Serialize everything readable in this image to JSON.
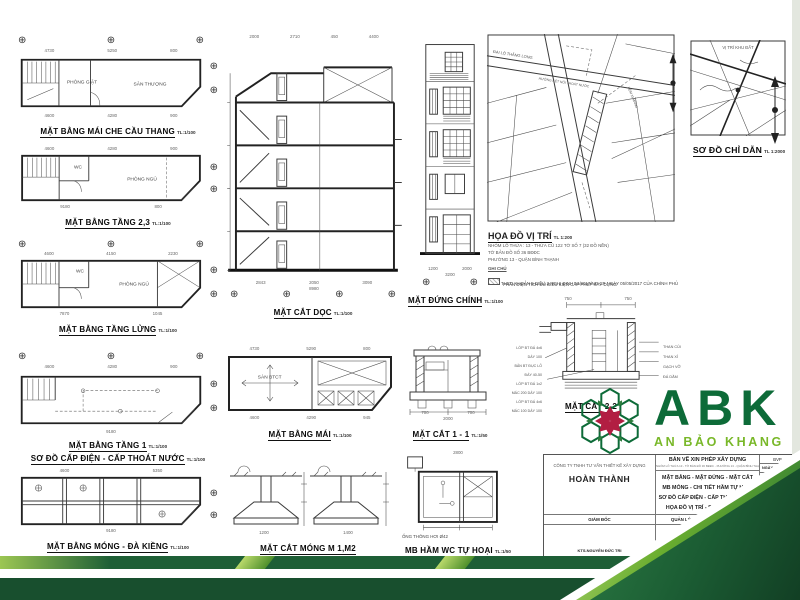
{
  "icons": {
    "axis_marker": "⊕"
  },
  "drawings": {
    "p1": {
      "title": "MẶT BẰNG MÁI CHE CẦU THANG",
      "scale": "TL:1/100",
      "room_a": "PHÒNG GIẶT",
      "room_b": "SÂN THƯỢNG",
      "dims_top": [
        "4730",
        "5250",
        "800"
      ],
      "dims_bottom": [
        "4600",
        "4280",
        "900"
      ]
    },
    "p2": {
      "title": "MẶT BẰNG TẦNG 2,3",
      "scale": "TL:1/100",
      "room_a": "WC",
      "room_b": "PHÒNG NGỦ",
      "dims_top": [
        "4600",
        "4280",
        "900"
      ],
      "dims_bottom": [
        "9180",
        "800"
      ]
    },
    "p3": {
      "title": "MẶT BẰNG TẦNG LỬNG",
      "scale": "TL:1/100",
      "room_a": "WC",
      "room_b": "PHÒNG NGỦ",
      "dims_top": [
        "4600",
        "4150",
        "2230"
      ],
      "dims_bottom": [
        "7870",
        "1045"
      ]
    },
    "p4": {
      "title": "MẶT BẰNG TẦNG 1",
      "scale": "TL:1/100",
      "subtitle": "SƠ ĐỒ CẤP ĐIỆN - CẤP THOÁT NƯỚC",
      "subtitle_scale": "TL:1/100",
      "dims_top": [
        "4600",
        "4280",
        "900"
      ],
      "dims_bottom": [
        "9180"
      ]
    },
    "p5": {
      "title": "MẶT BẰNG MÓNG - ĐÀ KIỀNG",
      "scale": "TL:1/100",
      "dims_top": [
        "4600",
        "5350"
      ],
      "dims_bottom": [
        "9180"
      ]
    },
    "sec": {
      "title": "MẶT CẮT DỌC",
      "scale": "TL:1/100",
      "dims_top": [
        "2000",
        "2710",
        "450",
        "4400"
      ],
      "dims_bottom": [
        "2843",
        "2050",
        "3090"
      ],
      "dim_overall": "8980"
    },
    "elev": {
      "title": "MẶT ĐỨNG CHÍNH",
      "scale": "TL:1/100",
      "dims_bottom": [
        "1200",
        "2000"
      ],
      "dim_overall": "3200"
    },
    "roof": {
      "title": "MẶT BẰNG MÁI",
      "scale": "TL:1/100",
      "room_a": "SÀN BTCT",
      "dims_top": [
        "4730",
        "5290",
        "800"
      ],
      "dims_bottom": [
        "4600",
        "4290",
        "945"
      ]
    },
    "s11": {
      "title": "MẶT CẮT 1 - 1",
      "scale": "TL:1/50",
      "dims_bottom": [
        "700",
        "700"
      ],
      "dim_overall": "2000"
    },
    "m12": {
      "title": "MẶT CẮT MÓNG M 1,M2",
      "dims": [
        "1200",
        "1400"
      ]
    },
    "septic": {
      "title": "MB HẦM WC TỰ HOẠI",
      "scale": "TL:1/50",
      "note": "ỐNG THÔNG HƠI Ø42",
      "dim_top": "2800"
    },
    "s22": {
      "title": "MẶT CẮT 2-2",
      "labels_left": [
        "LỚP BT ĐÁ 4x6 DÀY 100",
        "BẢN BT ĐỤC LỖ ĐÁY 40-50",
        "LỚP BT ĐÁ 1x2 MÁC 200 DÀY 100",
        "LỚP BT ĐÁ 4x6 MÁC 100 DÀY 100"
      ],
      "labels_right": [
        "THAN CỦI",
        "THAN XỈ",
        "GẠCH VỠ",
        "ĐÁ DĂM"
      ],
      "dims_top": [
        "750",
        "750"
      ]
    },
    "locmap": {
      "title": "HỌA ĐỒ VỊ TRÍ",
      "scale": "TL 1:200",
      "notes": [
        "NHÓM LÔ THỬA : 13 - THỬA CŨ 122 TỜ SỐ 7 (32 ĐỒ NỀN)",
        "TỜ BẢN ĐỒ SỐ 36 BĐĐC",
        "PHƯỜNG 13 - QUẬN BÌNH THẠNH"
      ],
      "note_title": "GHI CHÚ",
      "legend": [
        "PHẦN DIỆN TÍCH ĐỦ ĐIỀU KIỆN CẤP PHÉP XÂY DỰNG",
        "THEO KHOẢN 5 ĐIỀU 3 NGHỊ ĐỊNH 53/2017/NĐ-CP NGÀY 05/05/2017 CỦA CHÍNH PHỦ"
      ],
      "street_a": "ĐẠI LỘ THĂNG LONG",
      "street_b": "HƯỚNG KẾT NỐI THOÁT NƯỚC",
      "street_c": "HẺM XI MĂNG"
    },
    "guide": {
      "title": "SƠ ĐỒ CHỈ DẪN",
      "scale": "TL 1:2000",
      "label": "VỊ TRÍ KHU ĐẤT"
    }
  },
  "logo": {
    "abbr": "ABK",
    "name": "AN BẢO KHANG",
    "green_dark": "#0d6b38",
    "green_light": "#79b829",
    "red": "#b21e42"
  },
  "titleblock": {
    "doc_title": "BẢN VẼ XIN PHÉP XÂY DỰNG",
    "doc_subtitle": "NHÓM LÔ THỬA 13 - TỜ BẢN ĐỒ 36 BĐĐC - PHƯỜNG 13 - QUẬN BÌNH THẠNH",
    "company_label": "CÔNG TY TNHH TƯ VẤN THIẾT KẾ XÂY DỰNG",
    "company_name": "HOÀN THÀNH",
    "contents": [
      "MẶT BẰNG - MẶT ĐỨNG - MẶT CẮT",
      "MB MÓNG - CHI TIẾT HẦM TỰ HOẠI",
      "SƠ ĐỒ CẤP ĐIỆN - CẤP THOÁT NƯỚC",
      "HỌA ĐỒ VỊ TRÍ - SƠ ĐỒ CHỈ DẪN"
    ],
    "bvp": "BVP",
    "date": "NGÀY 12/03/2019",
    "paper": "A3",
    "stamp": "XP",
    "stamp_sub": "1:1",
    "scale_label": "TL",
    "code_label": "MÃ SỐ",
    "roles": [
      "GIÁM ĐỐC",
      "QUẢN LÝ KỸ THUẬT",
      "THIẾT KẾ"
    ],
    "signers": [
      "KTS.NGUYỄN ĐỨC TRI",
      "KS.NGUYỄN THẾ SANG",
      "KTS.NGUYỄN"
    ]
  }
}
